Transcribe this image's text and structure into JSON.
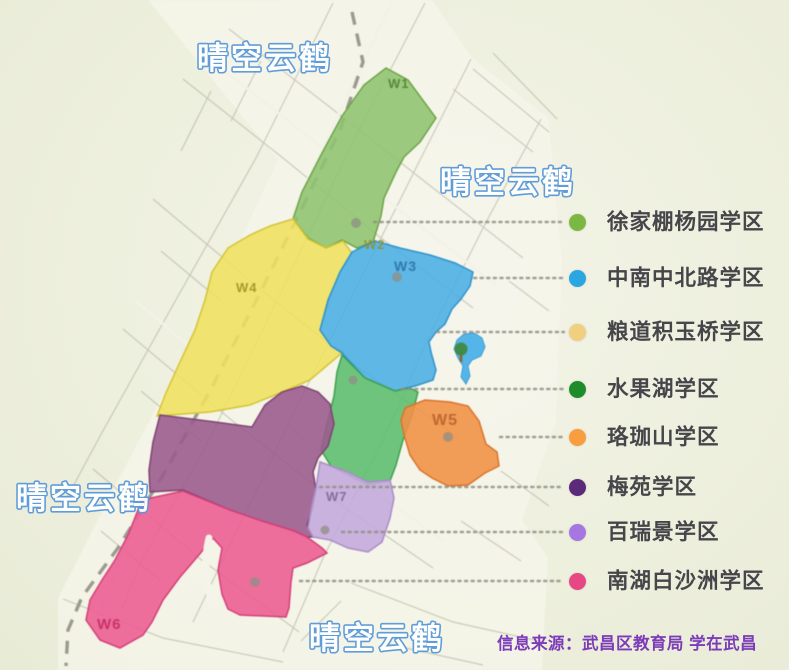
{
  "watermark": {
    "text": "晴空云鹤"
  },
  "map": {
    "area_labels": [
      {
        "code": "W1"
      },
      {
        "code": "W2"
      },
      {
        "code": "W3"
      },
      {
        "code": "W4"
      },
      {
        "code": "W5"
      },
      {
        "code": "W6"
      },
      {
        "code": "W7"
      }
    ],
    "regions": [
      {
        "name": "徐家棚杨园学区",
        "color": "#8ec46f"
      },
      {
        "name": "粮道积玉桥学区",
        "color": "#efe05e"
      },
      {
        "name": "中南中北路学区",
        "color": "#49aee4"
      },
      {
        "name": "水果湖学区",
        "color": "#5cbd6e"
      },
      {
        "name": "珞珈山学区",
        "color": "#ef9147"
      },
      {
        "name": "梅苑学区",
        "color": "#9a5c8e"
      },
      {
        "name": "百瑞景学区",
        "color": "#c3aadb"
      },
      {
        "name": "南湖白沙洲学区",
        "color": "#eb5e92"
      }
    ],
    "lake_color": "#55b4e8"
  },
  "legend": {
    "items": [
      {
        "label": "徐家棚杨园学区",
        "color": "#7bb843"
      },
      {
        "label": "中南中北路学区",
        "color": "#2aa7e0"
      },
      {
        "label": "粮道积玉桥学区",
        "color": "#f0cf7e"
      },
      {
        "label": "水果湖学区",
        "color": "#1d8c2a"
      },
      {
        "label": "珞珈山学区",
        "color": "#f89e3f"
      },
      {
        "label": "梅苑学区",
        "color": "#5b2a79"
      },
      {
        "label": "百瑞景学区",
        "color": "#a677e2"
      },
      {
        "label": "南湖白沙洲学区",
        "color": "#e74782"
      }
    ]
  },
  "source": {
    "text": "信息来源：武昌区教育局  学在武昌"
  }
}
